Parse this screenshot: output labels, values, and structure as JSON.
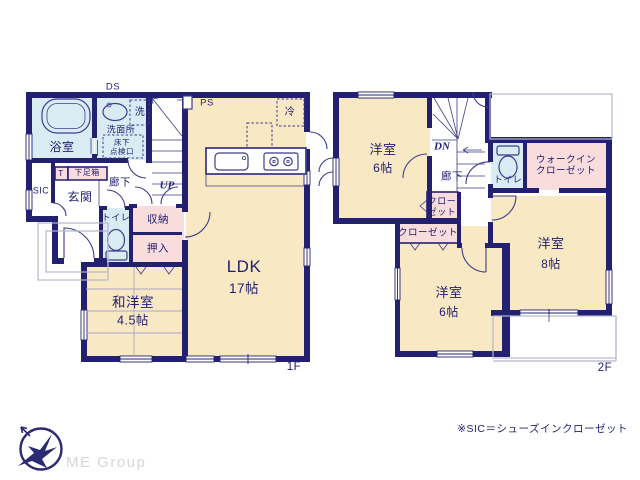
{
  "colors": {
    "wall": "#232072",
    "room_cream": "#f8e8c3",
    "wet_blue": "#d9ecf4",
    "closet_pink": "#f9dcdc",
    "fixture_line": "#3f3d8a",
    "gray_line": "#b3b7ce",
    "brand_navy": "#2b2a72",
    "brand_text": "#d6d6d8"
  },
  "f1": {
    "floor_label": "1F",
    "ds": "DS",
    "ps": "PS",
    "fridge": "冷",
    "bath": "浴室",
    "washer": "洗",
    "washroom": "洗面所",
    "floor_hatch": "床下\n点検口",
    "up": "UP",
    "hall": "廊下",
    "shoe_t": "T",
    "shoe_box": "下足箱",
    "sic": "SIC",
    "entrance": "玄関",
    "toilet": "トイレ",
    "storage": "収納",
    "oshiire": "押入",
    "washitsu_name": "和洋室",
    "washitsu_size": "4.5帖",
    "ldk_name": "LDK",
    "ldk_size": "17帖"
  },
  "f2": {
    "floor_label": "2F",
    "dn": "DN",
    "hall": "廊下",
    "toilet": "トイレ",
    "walk_in_closet": "ウォークイン\nクローゼット",
    "closet_small": "クロー\nゼット",
    "closet_wide": "クローゼット",
    "room_nw_name": "洋室",
    "room_nw_size": "6帖",
    "room_e_name": "洋室",
    "room_e_size": "8帖",
    "room_s_name": "洋室",
    "room_s_size": "6帖"
  },
  "footer": {
    "note": "※SIC＝シューズインクローゼット",
    "brand": "ME Group"
  }
}
